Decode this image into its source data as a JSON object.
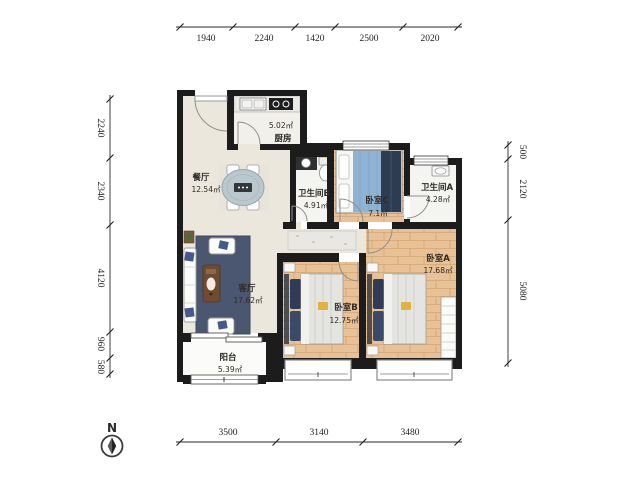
{
  "compass": {
    "label": "N"
  },
  "dimensions": {
    "top": [
      "1940",
      "2240",
      "1420",
      "2500",
      "2020"
    ],
    "left": [
      "2240",
      "2340",
      "4120",
      "960",
      "580"
    ],
    "right": [
      "500",
      "2120",
      "5080"
    ],
    "bottom": [
      "3500",
      "3140",
      "3480"
    ]
  },
  "rooms": {
    "kitchen": {
      "name": "厨房",
      "area": "5.02㎡"
    },
    "dining": {
      "name": "餐厅",
      "area": "12.54㎡"
    },
    "bath_b": {
      "name": "卫生间B",
      "area": "4.91㎡"
    },
    "bed_c": {
      "name": "卧室C",
      "area": "7.1㎡"
    },
    "bath_a": {
      "name": "卫生间A",
      "area": "4.28㎡"
    },
    "living": {
      "name": "客厅",
      "area": "17.62㎡"
    },
    "bed_b": {
      "name": "卧室B",
      "area": "12.75㎡"
    },
    "bed_a": {
      "name": "卧室A",
      "area": "17.68㎡"
    },
    "balcony": {
      "name": "阳台",
      "area": "5.39㎡"
    }
  },
  "colors": {
    "wall": "#1c1c1c",
    "wood_floor": "#e9c197",
    "tile_floor": "#f4f4f1",
    "living_floor": "#ece7dd",
    "rug": "#4b5671",
    "bed_blanket_blue": "#8fb3d3",
    "bed_pillow_navy": "#2f3b57",
    "accent_yellow": "#e3b23e"
  }
}
